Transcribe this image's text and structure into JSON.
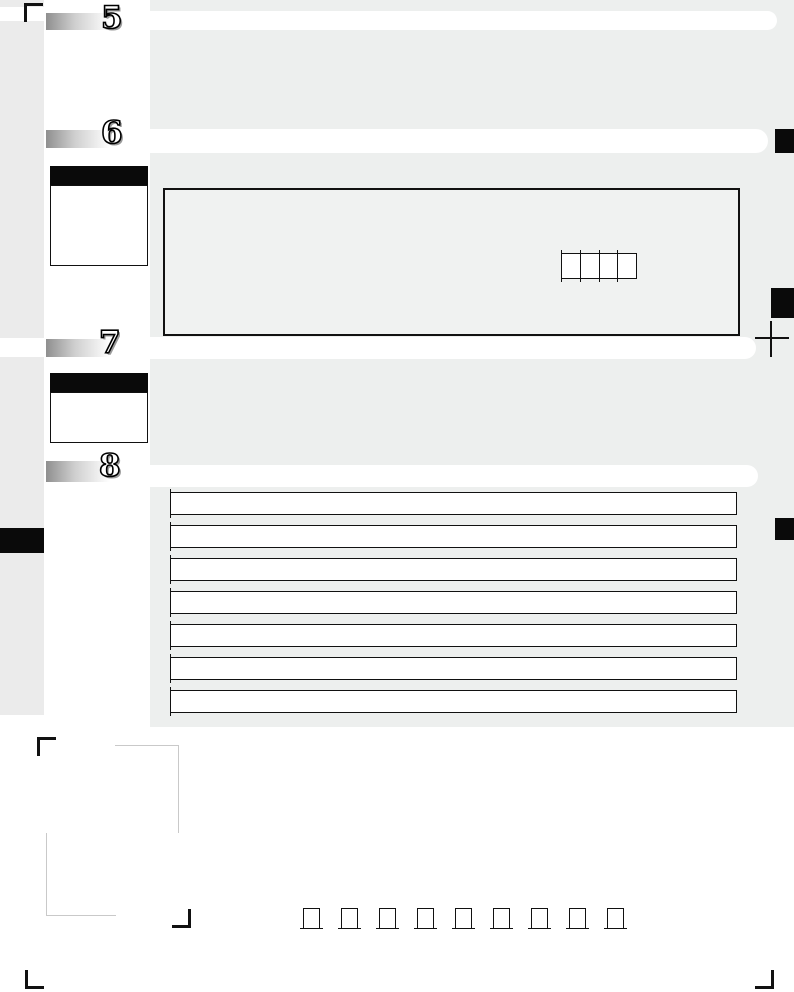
{
  "form": {
    "sections": [
      {
        "number": "5"
      },
      {
        "number": "6"
      },
      {
        "number": "7"
      },
      {
        "number": "8"
      }
    ],
    "section6": {
      "code_box_cells": 4
    },
    "char_grid": {
      "rows": 7,
      "cols": 29
    },
    "bottom_checkboxes": 9,
    "colors": {
      "band_gray": "#edefee",
      "left_column_gray": "#ebebeb",
      "entry_box_fill": "#f0f2f1",
      "mark_black": "#0a0a0a",
      "guide_gray": "#c9c9c9"
    }
  }
}
